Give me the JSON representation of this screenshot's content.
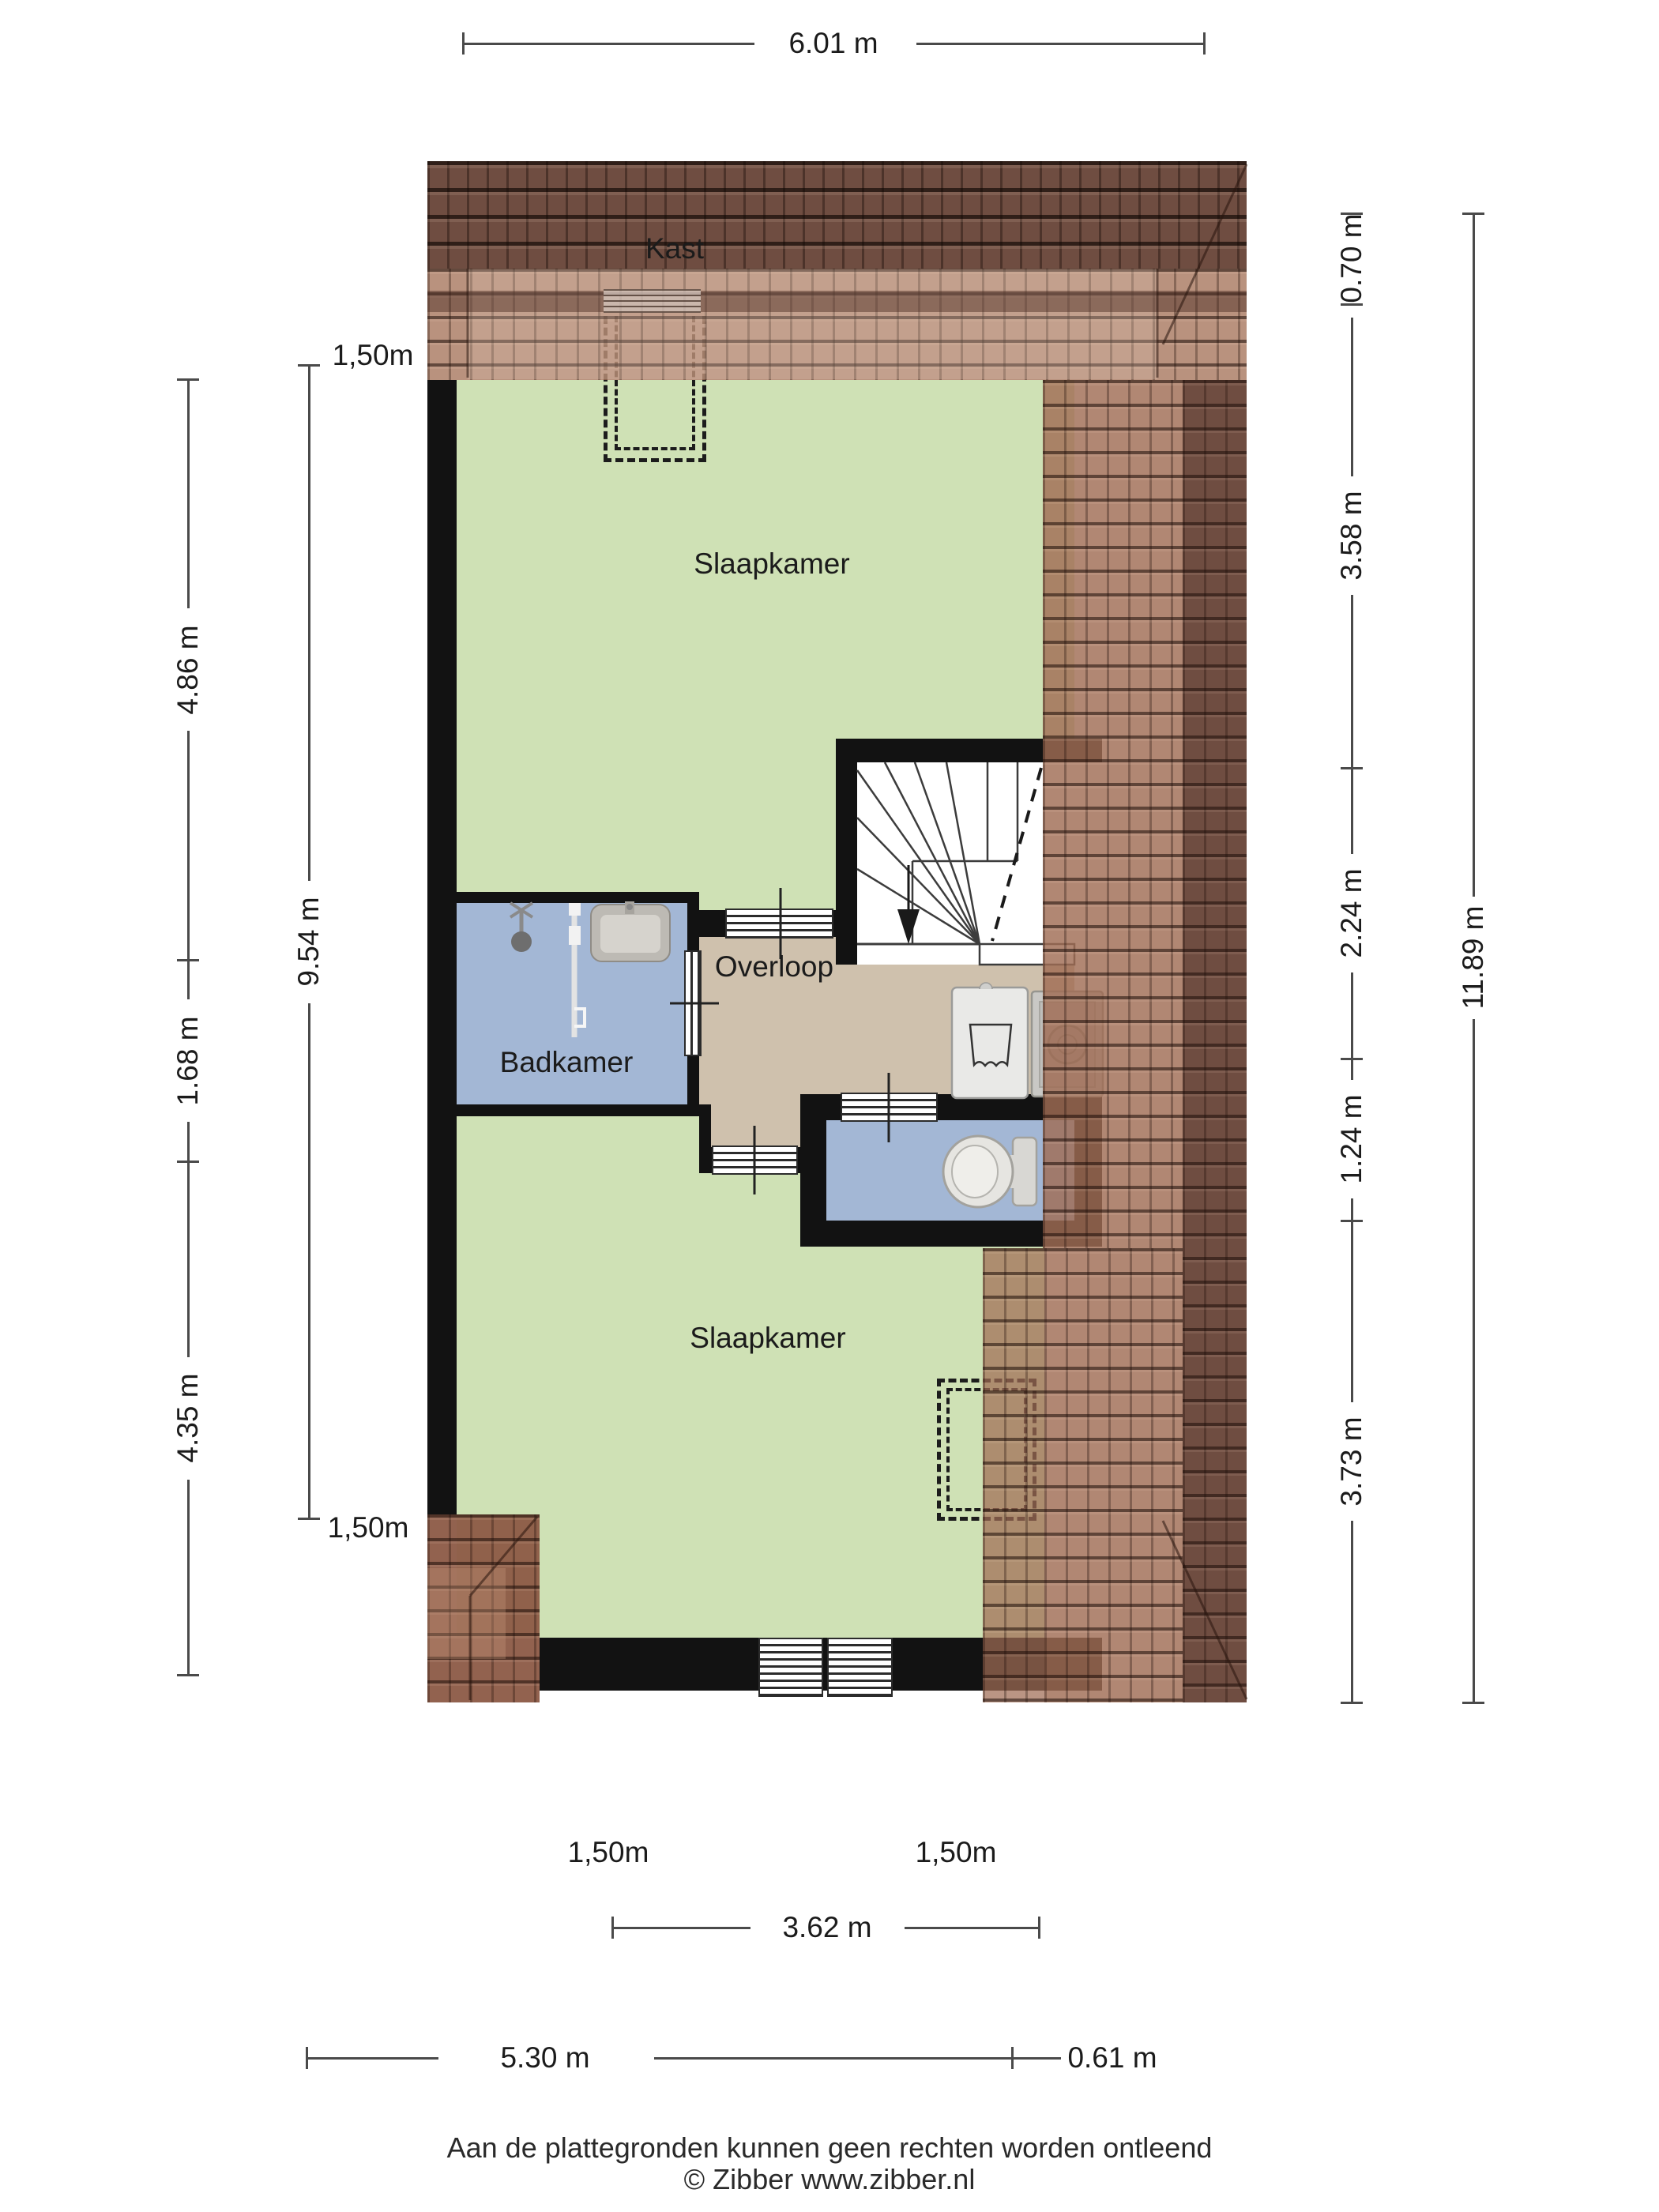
{
  "rooms": {
    "kast": "Kast",
    "slaapkamer_top": "Slaapkamer",
    "badkamer": "Badkamer",
    "overloop": "Overloop",
    "slaapkamer_bottom": "Slaapkamer"
  },
  "dims": {
    "top_width": "6.01 m",
    "left_segments": [
      "4.86 m",
      "1.68 m",
      "4.35 m"
    ],
    "left_total": "9.54 m",
    "clearance_top_left": "1,50m",
    "clearance_bottom_left": "1,50m",
    "clearance_bottom_center_left": "1,50m",
    "clearance_bottom_center_right": "1,50m",
    "right_segments": [
      "0.70 m",
      "3.58 m",
      "2.24 m",
      "1.24 m",
      "3.73 m"
    ],
    "right_total": "11.89 m",
    "bottom_inner": "3.62 m",
    "bottom_outer": "5.30 m",
    "bottom_offset": "0.61 m"
  },
  "footer": {
    "disclaimer": "Aan de plattegronden kunnen geen rechten worden ontleend",
    "credit": "© Zibber www.zibber.nl"
  },
  "colors": {
    "room_green": "#cfe1b5",
    "room_blue": "#a3b7d5",
    "room_tan": "#cfc1ad",
    "wall": "#121212",
    "roof_light": "rgba(165,115,90,0.78)",
    "roof_mid": "rgba(160,108,84,0.82)",
    "roof_dark": "rgba(95,58,44,0.90)",
    "dim_line": "#4a4a4a"
  }
}
